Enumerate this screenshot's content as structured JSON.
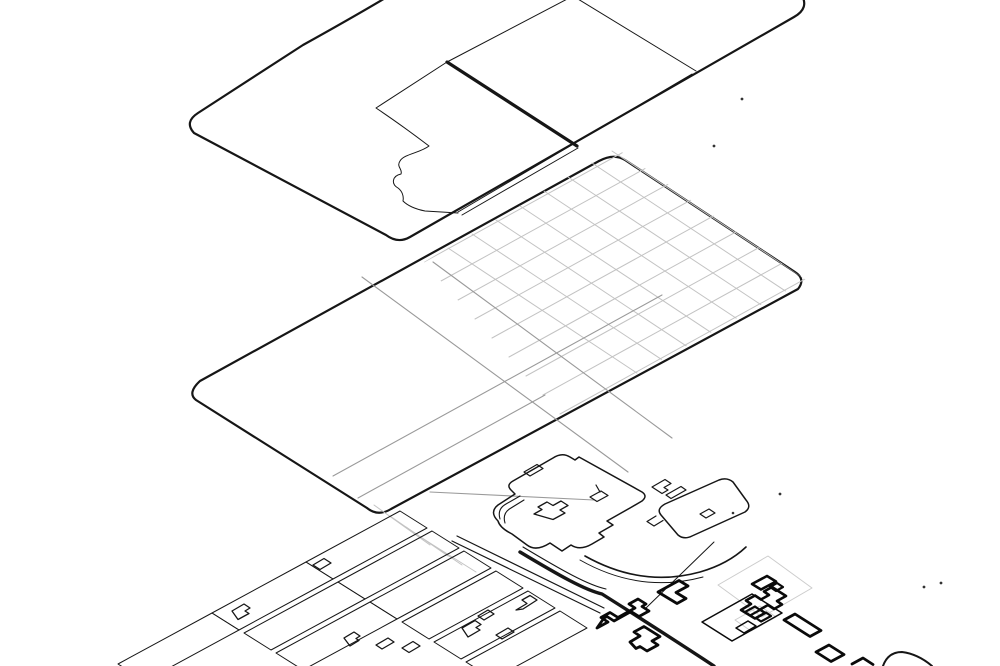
{
  "diagram": {
    "type": "exploded-axonometric-site-diagram",
    "layer_count": 3,
    "background": "#ffffff"
  },
  "colors": {
    "ink": "#161616",
    "grid_light": "#c3c3c3",
    "street_gray": "#9a9a9a",
    "parcel_gray": "#cccccc",
    "footprint_ink": "#0a0a0a",
    "dot": "#333333"
  },
  "layers": [
    {
      "name": "top-boundary-layer"
    },
    {
      "name": "middle-street-grid-layer"
    },
    {
      "name": "bottom-building-fabric-layer"
    }
  ]
}
